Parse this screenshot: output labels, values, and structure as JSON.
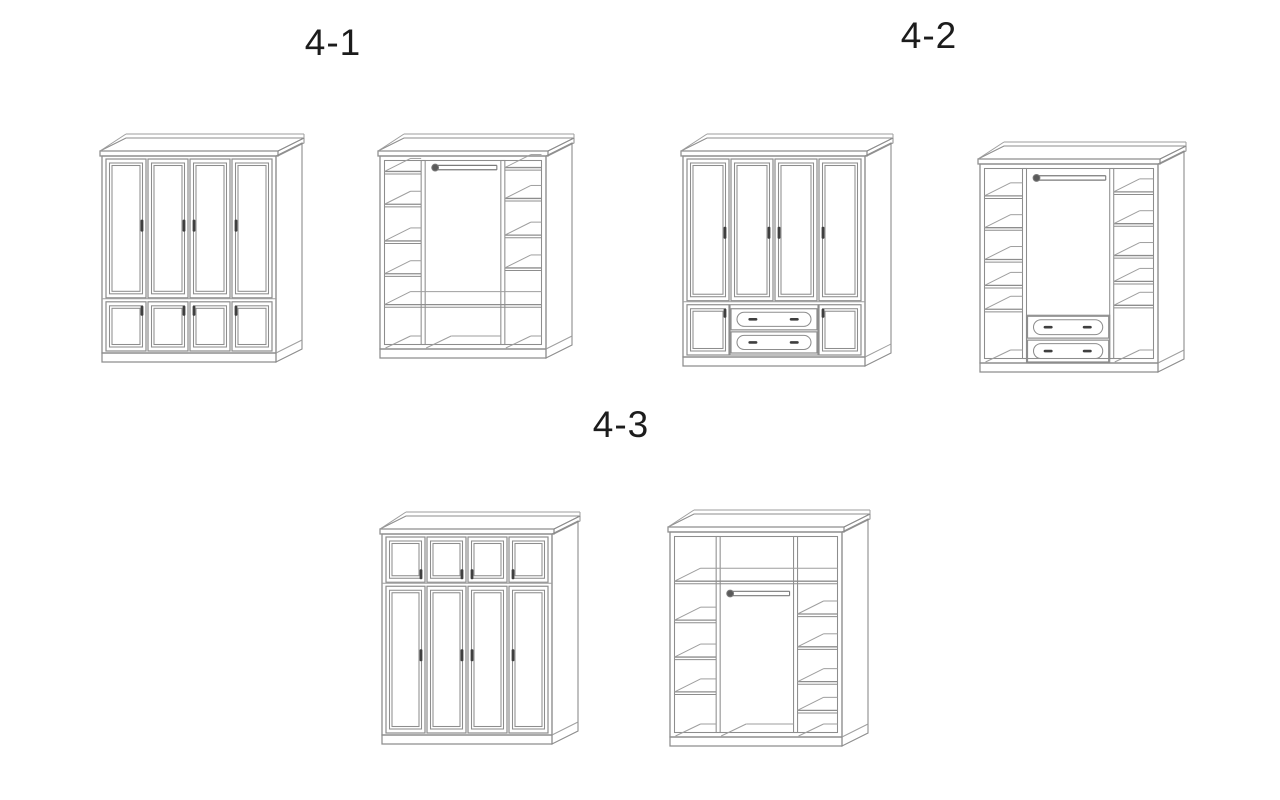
{
  "page": {
    "background": "#ffffff",
    "kind": "wardrobe-configuration-diagram"
  },
  "palette": {
    "line": "#8d8d8d",
    "line_soft": "#9e9e9e",
    "handle": "#3f3f3f",
    "rod": "#7a7a7a",
    "rod_mount_fill": "#5a5a5a",
    "label_color": "#1c1c1c"
  },
  "groups": [
    {
      "id": "4-1",
      "label": "4-1"
    },
    {
      "id": "4-2",
      "label": "4-2"
    },
    {
      "id": "4-3",
      "label": "4-3"
    }
  ],
  "figures": [
    {
      "name": "wardrobe-4-1-exterior",
      "group": "4-1",
      "view": "exterior",
      "spec": {
        "columns": 4,
        "divider": 0.73,
        "top_row": "tall-doors",
        "bottom_row": "small-doors",
        "handle_sides": [
          "right",
          "right",
          "left",
          "left"
        ],
        "tall_handle_frac": 0.48
      }
    },
    {
      "name": "wardrobe-4-1-interior",
      "group": "4-1",
      "view": "interior",
      "spec": {
        "partitions": [
          0.26,
          0.74
        ],
        "rod_y": 0.06,
        "wide_shelf": 0.77,
        "left_shelves": [
          0.08,
          0.25,
          0.44,
          0.61
        ],
        "right_shelves": [
          0.06,
          0.22,
          0.41,
          0.58
        ],
        "floor_compartments": "three"
      }
    },
    {
      "name": "wardrobe-4-2-exterior",
      "group": "4-2",
      "view": "exterior",
      "spec": {
        "columns": 4,
        "divider": 0.73,
        "top_row": "tall-doors",
        "bottom_row": "door-drawers-door",
        "drawer_count": 2,
        "handle_sides": [
          "right",
          "right",
          "left",
          "left"
        ],
        "tall_handle_frac": 0.52
      }
    },
    {
      "name": "wardrobe-4-2-interior",
      "group": "4-2",
      "view": "interior",
      "spec": {
        "partitions": [
          0.25,
          0.74
        ],
        "rod_y": 0.07,
        "left_shelves": [
          0.16,
          0.32,
          0.48,
          0.61,
          0.73
        ],
        "right_shelves": [
          0.14,
          0.3,
          0.46,
          0.59,
          0.71
        ],
        "center_drawers": {
          "top": 0.76,
          "count": 2
        }
      }
    },
    {
      "name": "wardrobe-4-3-exterior",
      "group": "4-3",
      "view": "exterior",
      "spec": {
        "columns": 4,
        "divider": 0.25,
        "top_row": "small-doors",
        "bottom_row": "tall-doors",
        "handle_sides": [
          "right",
          "right",
          "left",
          "left"
        ],
        "tall_handle_frac": 0.47
      }
    },
    {
      "name": "wardrobe-4-3-interior",
      "group": "4-3",
      "view": "interior",
      "spec": {
        "partitions": [
          0.28,
          0.73
        ],
        "full_shelf": 0.24,
        "rod_y": 0.3,
        "left_shelves": [
          0.43,
          0.61,
          0.78
        ],
        "right_shelves": [
          0.4,
          0.56,
          0.73,
          0.87
        ]
      }
    }
  ]
}
